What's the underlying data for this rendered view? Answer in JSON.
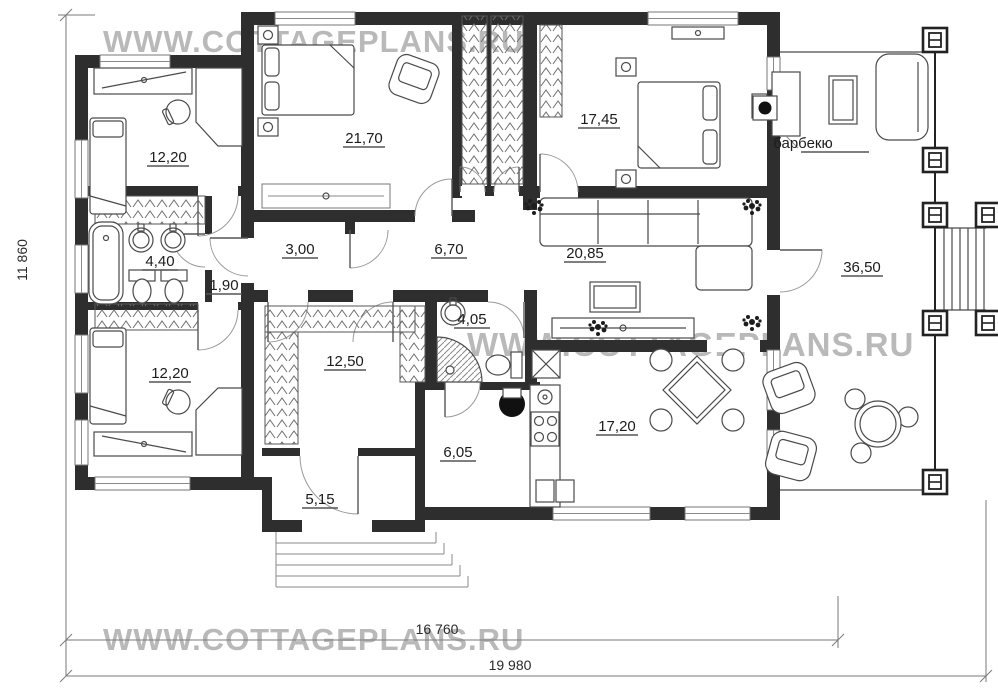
{
  "watermarks": {
    "top": "WWW.COTTAGEPLANS.RU",
    "middle": "WWW.COTTAGEPLANS.RU",
    "bottom": "WWW.COTTAGEPLANS.RU"
  },
  "dimensions": {
    "height_total": "11 860",
    "width_inner": "16 760",
    "width_total": "19 980"
  },
  "annotations": {
    "barbecue": "барбекю"
  },
  "rooms": {
    "bedroom_top_left": {
      "area": "12,20"
    },
    "bedroom_master": {
      "area": "21,70"
    },
    "bedroom_right": {
      "area": "17,45"
    },
    "bathroom_main": {
      "area": "4,40"
    },
    "vestibule": {
      "area": "1,90"
    },
    "corridor": {
      "area": "3,00"
    },
    "hallway": {
      "area": "6,70"
    },
    "living_room": {
      "area": "20,85"
    },
    "terrace": {
      "area": "36,50"
    },
    "bedroom_bottom_left": {
      "area": "12,20"
    },
    "wardrobe": {
      "area": "12,50"
    },
    "shower_room": {
      "area": "4,05"
    },
    "kitchen_dining": {
      "area": "17,20"
    },
    "hall": {
      "area": "6,05"
    },
    "entry": {
      "area": "5,15"
    }
  },
  "colors": {
    "wall": "#2e2e2e",
    "watermark": "#b9b9b9"
  }
}
